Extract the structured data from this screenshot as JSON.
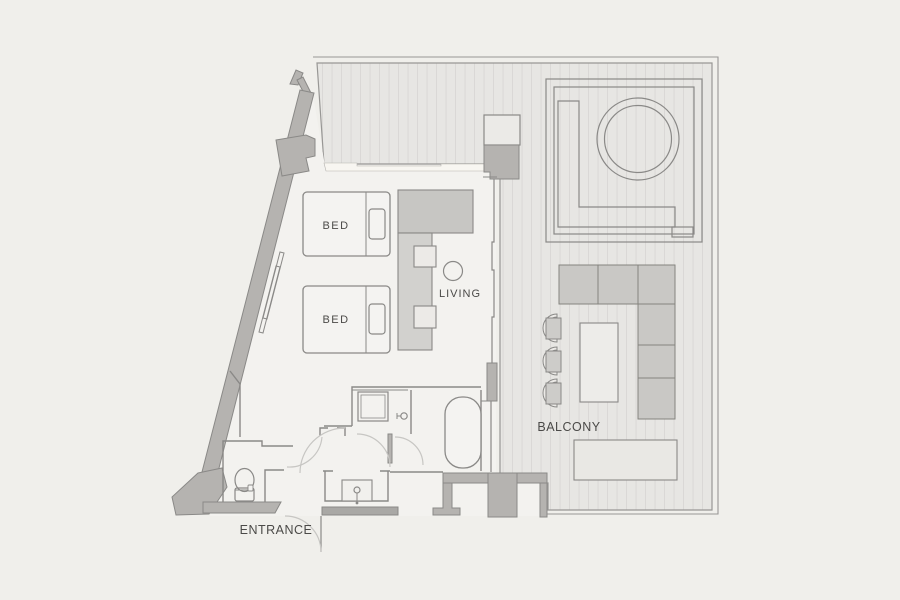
{
  "plan": {
    "type": "apartment-floor-plan",
    "labels": {
      "bed1": "BED",
      "bed2": "BED",
      "living": "LIVING",
      "balcony": "BALCONY",
      "entrance": "ENTRANCE"
    },
    "rooms": [
      "bedroom-living",
      "bathroom",
      "shower-room",
      "toilet-room",
      "entrance-hall",
      "balcony"
    ],
    "fixtures": [
      "twin-bed",
      "twin-bed",
      "kitchen-counter",
      "bar-stools",
      "round-side-table",
      "bathtub",
      "shower",
      "toilet",
      "sink",
      "hot-tub",
      "sectional-sofa",
      "coffee-table",
      "outdoor-chairs",
      "outdoor-bench"
    ]
  },
  "colors": {
    "page_bg": "#f0efeb",
    "interior_floor": "#f3f2ef",
    "balcony_deck": "#e7e6e3",
    "deck_stripe": "#d8d7d4",
    "wall_fill": "#b5b3b0",
    "wall_dark": "#a9a8a5",
    "line": "#8a8987",
    "door_arc": "#c7c6c3",
    "furniture_light": "#f4f3f1",
    "sofa_gray": "#c9c8c5",
    "counter_dark": "#c7c6c3",
    "counter_light": "#d2d1ce",
    "cream_wall": "#f8f6f1",
    "label_text": "#4b4a48"
  }
}
